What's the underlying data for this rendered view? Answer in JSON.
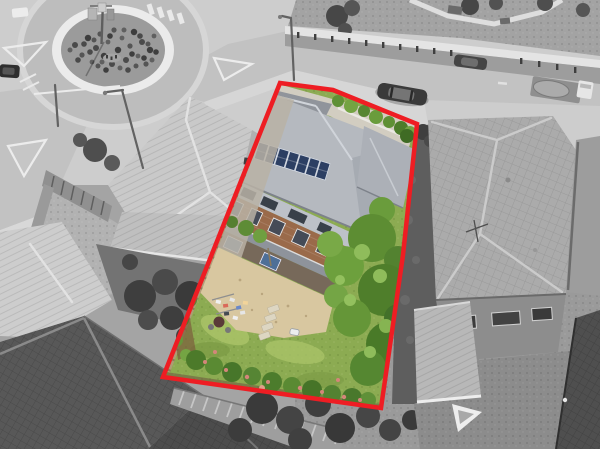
{
  "scene": {
    "type": "aerial-photograph",
    "style": "surroundings desaturated to grayscale, subject property lot shown in color with red boundary outline"
  },
  "palette": {
    "boundary_red": "#ee1d23",
    "lawn_green": "#8cab52",
    "lawn_light": "#abc469",
    "sand_paving": "#d8c7a0",
    "roof_gray": "#b5b9bf",
    "roof_gray_dark": "#a6abb2",
    "solar_panel_blue": "#2c3f63",
    "brick_brown": "#9a6a4a",
    "tree_green": "#5d8d33",
    "tree_green_dark": "#47762a",
    "tree_green_light": "#79a947",
    "flower_pink": "#d4867a",
    "fence_tan": "#b09a78",
    "road_gray": "#c2c2c2",
    "footpath_gray": "#e4e4e4",
    "neighbor_roof_gray": "#ababab",
    "dark_tile_roof_gray": "#585858"
  },
  "boundary": {
    "points": "280,83 333,90 417,124 403,255 381,408 163,377",
    "stroke_width": 4.5,
    "color": "#ee1d23"
  },
  "subject_lot": {
    "solar_panel_count": 8,
    "stepping_stone_count": 4
  }
}
